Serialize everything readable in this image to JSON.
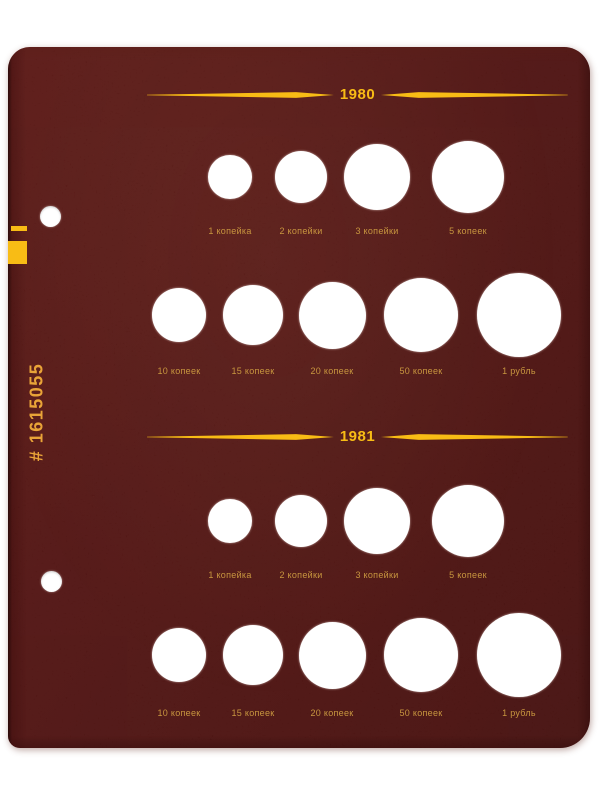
{
  "page": {
    "spine_code": "# 1615055"
  },
  "colors": {
    "page_maroon": "#5e1413",
    "accent_yellow": "#f8bc15",
    "label_gold": "#c8963f",
    "spine_code_gold": "#e9a438",
    "hole_white": "#ffffff"
  },
  "sections": [
    {
      "year": "1980",
      "rows": [
        {
          "coins": [
            {
              "label": "1 копейка"
            },
            {
              "label": "2 копейки"
            },
            {
              "label": "3 копейки"
            },
            {
              "label": "5 копеек"
            }
          ]
        },
        {
          "coins": [
            {
              "label": "10 копеек"
            },
            {
              "label": "15 копеек"
            },
            {
              "label": "20 копеек"
            },
            {
              "label": "50 копеек"
            },
            {
              "label": "1 рубль"
            }
          ]
        }
      ]
    },
    {
      "year": "1981",
      "rows": [
        {
          "coins": [
            {
              "label": "1 копейка"
            },
            {
              "label": "2 копейки"
            },
            {
              "label": "3 копейки"
            },
            {
              "label": "5 копеек"
            }
          ]
        },
        {
          "coins": [
            {
              "label": "10 копеек"
            },
            {
              "label": "15 копеек"
            },
            {
              "label": "20 копеек"
            },
            {
              "label": "50 копеек"
            },
            {
              "label": "1 рубль"
            }
          ]
        }
      ]
    }
  ]
}
